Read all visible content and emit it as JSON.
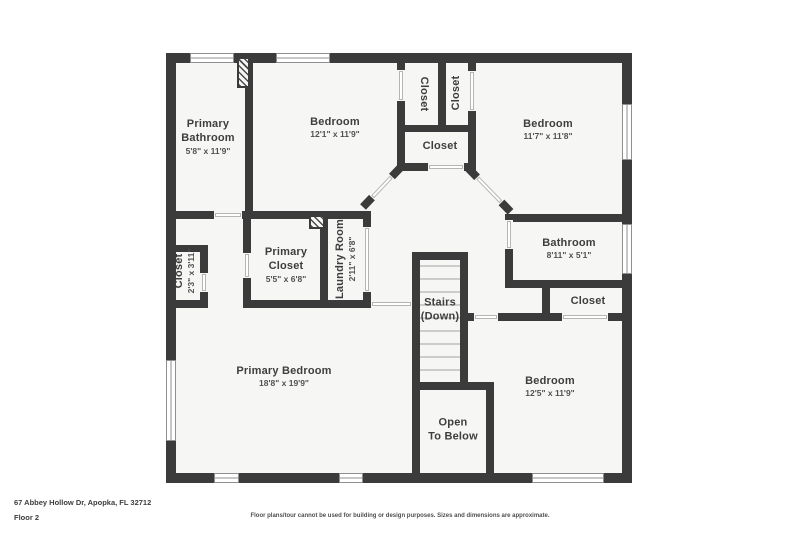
{
  "title_block": {
    "address": "67 Abbey Hollow Dr, Apopka, FL 32712",
    "floor": "Floor 2",
    "disclaimer": "Floor plans/tour cannot be used for building or design purposes. Sizes and dimensions are approximate."
  },
  "colors": {
    "wall": "#3b3b3b",
    "room_fill": "#f6f6f4",
    "stair_tread": "#cccccc"
  },
  "rooms": [
    {
      "id": "primary-bathroom",
      "name1": "Primary",
      "name2": "Bathroom",
      "dims": "5'8\" x 11'9\""
    },
    {
      "id": "bedroom-top-left",
      "name1": "Bedroom",
      "dims": "12'1\" x 11'9\""
    },
    {
      "id": "closet-top-left",
      "name1": "Closet"
    },
    {
      "id": "closet-top-right",
      "name1": "Closet"
    },
    {
      "id": "closet-center",
      "name1": "Closet"
    },
    {
      "id": "bedroom-top-right",
      "name1": "Bedroom",
      "dims": "11'7\" x 11'8\""
    },
    {
      "id": "closet-small",
      "name1": "Closet",
      "dims": "2'3\" x 3'11\""
    },
    {
      "id": "primary-closet",
      "name1": "Primary",
      "name2": "Closet",
      "dims": "5'5\" x 6'8\""
    },
    {
      "id": "laundry-room",
      "name1": "Laundry Room",
      "dims": "2'11\" x 6'8\""
    },
    {
      "id": "bathroom",
      "name1": "Bathroom",
      "dims": "8'11\" x 5'1\""
    },
    {
      "id": "stairs",
      "name1": "Stairs",
      "name2": "(Down)"
    },
    {
      "id": "closet-bedroom-right",
      "name1": "Closet"
    },
    {
      "id": "primary-bedroom",
      "name1": "Primary Bedroom",
      "dims": "18'8\" x 19'9\""
    },
    {
      "id": "bedroom-bottom-right",
      "name1": "Bedroom",
      "dims": "12'5\" x 11'9\""
    },
    {
      "id": "open-to-below",
      "name1": "Open",
      "name2": "To Below"
    }
  ]
}
